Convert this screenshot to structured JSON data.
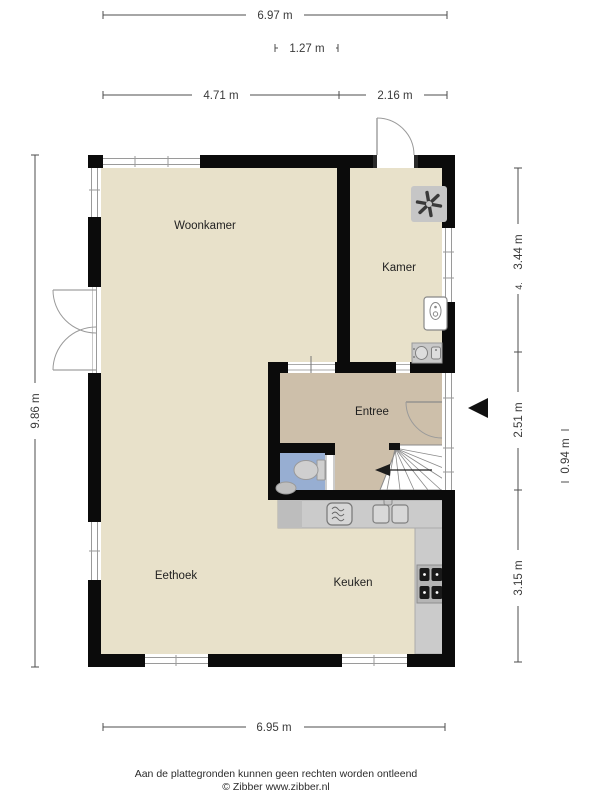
{
  "plan": {
    "rooms": {
      "woonkamer": "Woonkamer",
      "kamer": "Kamer",
      "entree": "Entree",
      "eethoek": "Eethoek",
      "keuken": "Keuken"
    },
    "dims": {
      "top_total": "6.97 m",
      "top_inner": "1.27 m",
      "top_left": "4.71 m",
      "top_right": "2.16 m",
      "left_total": "9.86 m",
      "right_kamer": "3.44 m",
      "right_kamer_extra": "4.",
      "right_entree": "2.51 m",
      "right_door": "0.94 m",
      "right_keuken": "3.15 m",
      "bottom_total": "6.95 m"
    },
    "colors": {
      "wall": "#0b0b0b",
      "floor_main": "#E8E1CA",
      "floor_entree": "#CDBFAA",
      "floor_toilet": "#97AED2",
      "counter": "#CBCBCB"
    }
  },
  "footer": {
    "disclaimer": "Aan de plattegronden kunnen geen rechten worden ontleend",
    "copyright": "© Zibber www.zibber.nl"
  }
}
